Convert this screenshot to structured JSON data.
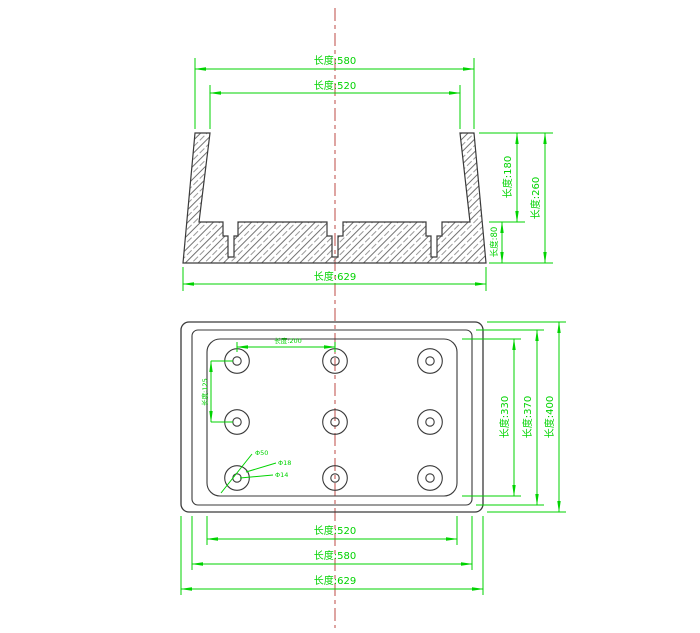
{
  "drawing": {
    "type": "engineering-cad-drawing",
    "colors": {
      "dimension_green": "#00d300",
      "centerline_red": "#c25b56",
      "outline_dark": "#3a3a3a",
      "background": "#ffffff"
    },
    "section_view": {
      "dims": {
        "top_outer_width": "长度:580",
        "top_inner_width": "长度:520",
        "bottom_width": "长度:629",
        "wall_height": "长度:180",
        "total_height": "长度:260",
        "base_height": "长度:80"
      }
    },
    "plan_view": {
      "dims": {
        "hole_spacing_horizontal": "长度:200",
        "hole_spacing_vertical": "长度:125",
        "inner_height": "长度:330",
        "middle_height": "长度:370",
        "outer_height": "长度:400",
        "inner_width": "长度:520",
        "middle_width": "长度:580",
        "outer_width": "长度:629"
      },
      "hole_callouts": [
        "Φ50",
        "Φ18",
        "Φ14"
      ],
      "hole_grid": {
        "rows": 3,
        "cols": 3
      }
    }
  }
}
